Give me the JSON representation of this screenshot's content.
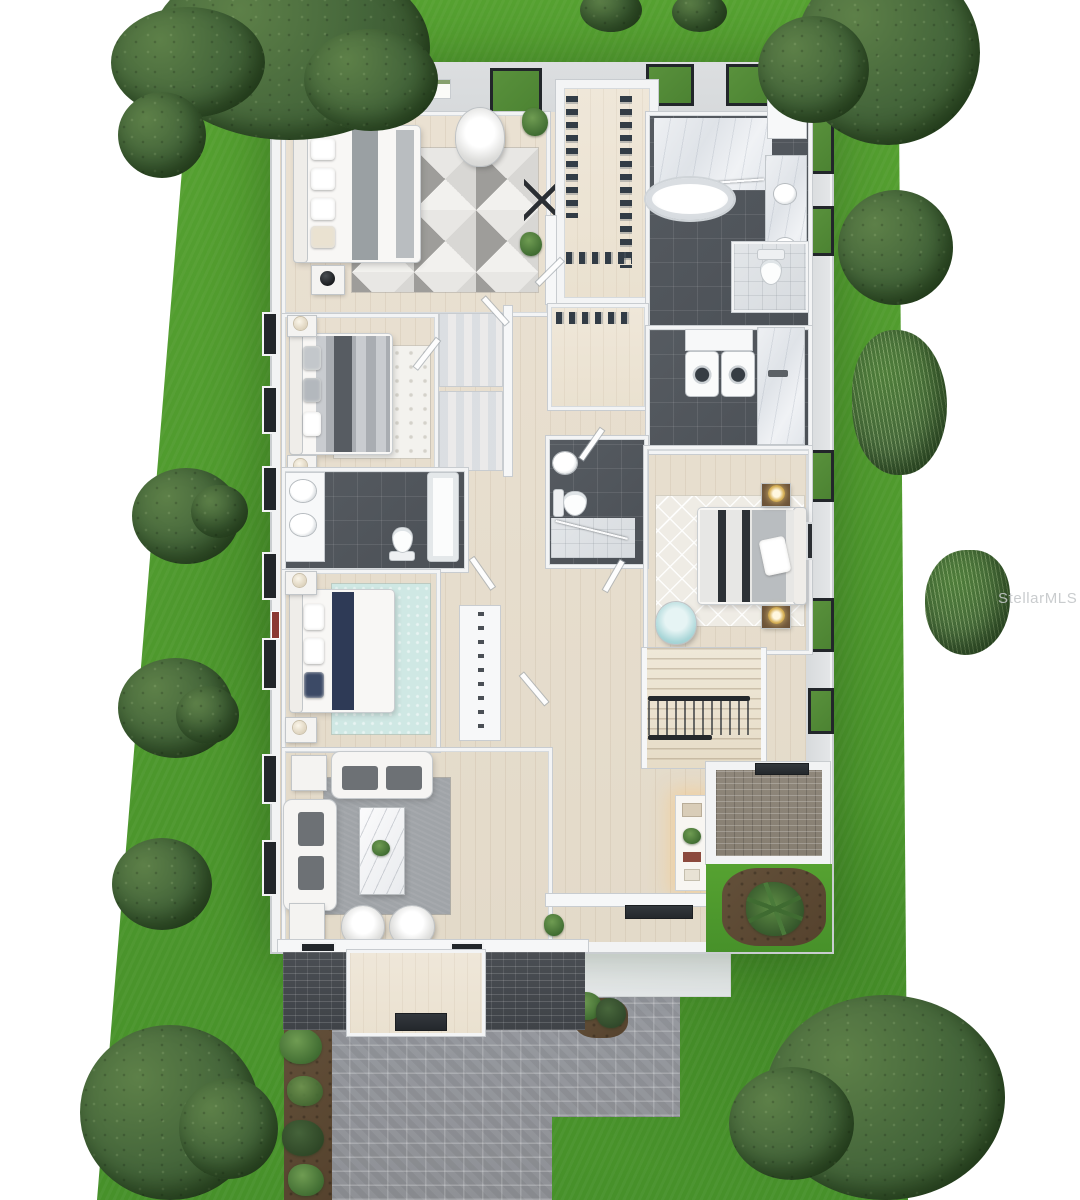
{
  "watermark": {
    "text": "StellarMLS"
  },
  "palette": {
    "grass": "#56a231",
    "grassDark": "#47912a",
    "treeDark": "#44653a",
    "treeMid": "#5d8048",
    "bushGreen": "#4e7d3a",
    "wall": "#f2f3f4",
    "wallBand": "#d7dadc",
    "frame": "#22262a",
    "wood": "#eae1d2",
    "woodDark": "#e3dac9",
    "tile": "#565b61",
    "tileDark": "#4b5056",
    "paver": "#979aa0",
    "paverDark": "#3f4348",
    "paverBrown": "#867e71",
    "mulch": "#55422d",
    "tealRug": "#cfe8e4",
    "teal": "#a9d6d8",
    "navy": "#2e3a56",
    "rugGray": "#a0a4a8",
    "gold": "#d8b25a",
    "watermarkColor": "#c4c7c9"
  },
  "scene": {
    "type": "3d-rendered-floor-plan",
    "view": "top-down dollhouse aerial",
    "ground": "green lawn lot with white page margins",
    "rooms": [
      {
        "name": "primary-bedroom",
        "items": [
          "bed",
          "nightstands",
          "lamps",
          "geometric-rug",
          "barrel-chair",
          "potted-plants",
          "wall-art"
        ]
      },
      {
        "name": "walk-in-closet",
        "items": [
          "hanging-clothes",
          "shelving"
        ]
      },
      {
        "name": "primary-bathroom",
        "items": [
          "freestanding-tub",
          "marble-shower",
          "double-vanity",
          "built-in-cabinet"
        ]
      },
      {
        "name": "water-closet",
        "items": [
          "toilet"
        ]
      },
      {
        "name": "bedroom-2",
        "items": [
          "bed",
          "trellis-rug",
          "nightstands",
          "lamps"
        ]
      },
      {
        "name": "hall-closets",
        "items": [
          "shelving-units",
          "hanging-clothes"
        ]
      },
      {
        "name": "laundry-room",
        "items": [
          "washer",
          "dryer",
          "upper-cabinets",
          "marble-counter",
          "sink"
        ]
      },
      {
        "name": "bathroom-2",
        "items": [
          "double-sink-vanity",
          "tub",
          "toilet"
        ]
      },
      {
        "name": "bathroom-3",
        "items": [
          "sink",
          "toilet",
          "shower"
        ]
      },
      {
        "name": "bedroom-3",
        "items": [
          "bed",
          "diamond-rug",
          "nightstands",
          "gold-lamps",
          "teal-barrel-chair",
          "wall-art"
        ]
      },
      {
        "name": "bedroom-4",
        "items": [
          "bed-navy-runner",
          "teal-rug",
          "nightstands",
          "wardrobe"
        ]
      },
      {
        "name": "living-room",
        "items": [
          "two-sofas",
          "gray-rug",
          "marble-coffee-table",
          "side-tables",
          "two-barrel-chairs",
          "plants"
        ]
      },
      {
        "name": "foyer-hall",
        "items": [
          "staircase",
          "console-table",
          "door-mat"
        ]
      },
      {
        "name": "rear-lanai",
        "items": [
          "brick-pavers",
          "grill-mat"
        ]
      },
      {
        "name": "front-porch",
        "items": [
          "wood-deck",
          "dark-paver-wings",
          "door-mat"
        ]
      }
    ],
    "landscape": [
      "trees",
      "shrubs",
      "ornamental-grasses",
      "mulch-beds",
      "paver-driveway",
      "concrete-pad",
      "garden-bed-with-palm"
    ]
  }
}
